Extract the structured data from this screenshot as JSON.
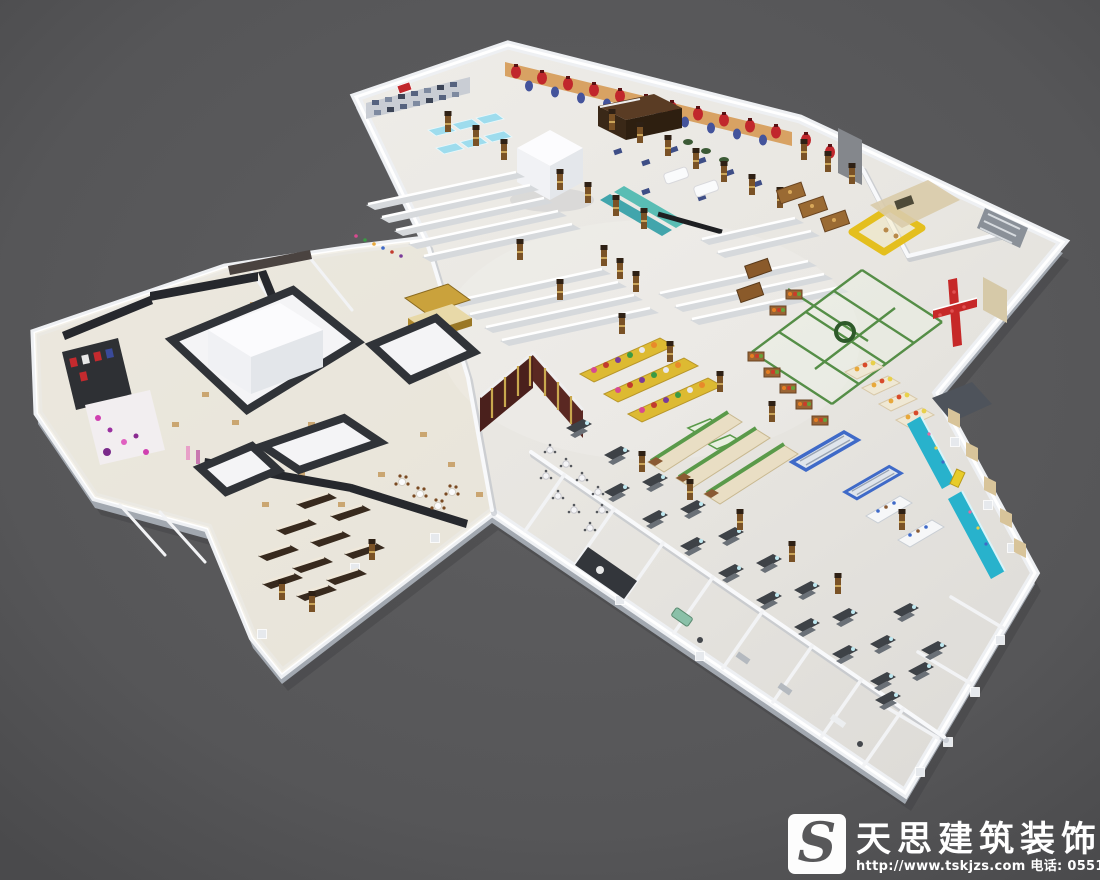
{
  "watermark": {
    "brand": "天思建筑装饰",
    "contact": "http://www.tskjzs.com 电话: 0551-65568226",
    "logo_letter": "S"
  },
  "palette": {
    "background": "#58585a",
    "building_white": "#f3f4f6",
    "floor": "#e8e6e1",
    "mall_floor": "#e9e3d6",
    "accent_teal": "#28b2cc",
    "accent_yellow": "#e4bf1e",
    "accent_red": "#c1272c",
    "accent_green": "#4e8a3f",
    "accent_blue": "#3f6ac8",
    "accent_maroon": "#4a201c",
    "wood_brown": "#7a5226",
    "counter_gray": "#3e4247",
    "storefront_dark": "#26282d"
  }
}
